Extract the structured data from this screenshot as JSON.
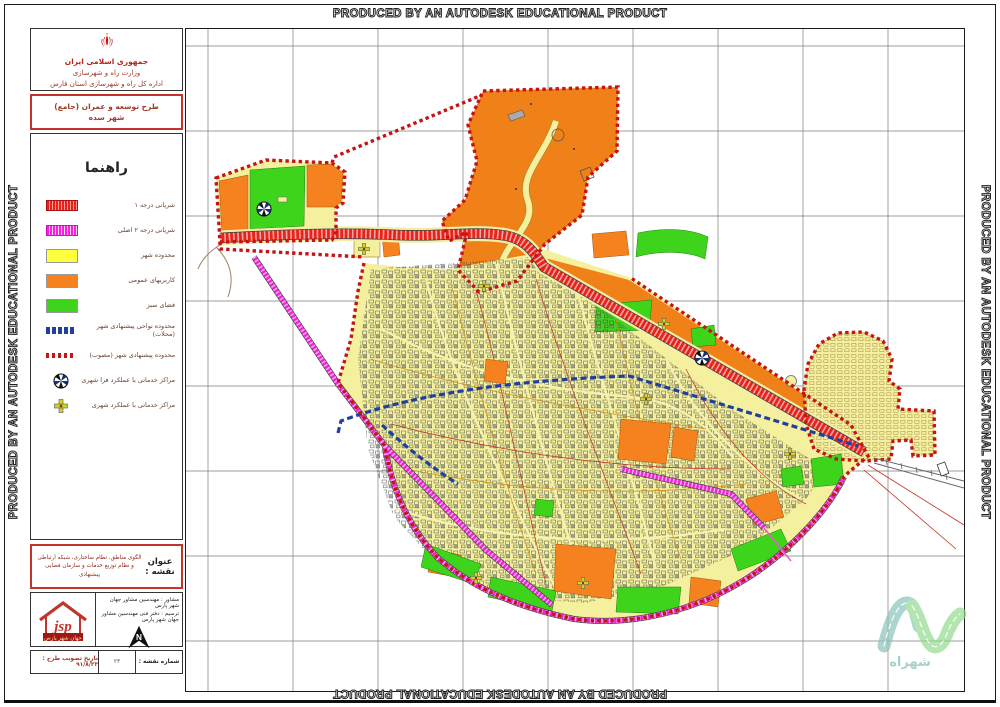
{
  "watermark": {
    "text": "PRODUCED BY AN AUTODESK EDUCATIONAL PRODUCT"
  },
  "header": {
    "line1": "جمهوری اسلامی ایران",
    "line2": "وزارت راه و شهرسازی",
    "line3": "اداره کل راه و شهرسازی استان فارس"
  },
  "plan_box": {
    "line1": "طرح توسعه و عمران (جامع)",
    "line2": "شهر سده"
  },
  "legend": {
    "title": "راهنما",
    "items": [
      {
        "label": "شریانی درجه ۱",
        "swatch": "red-hatch-bar",
        "color": "#e8231a"
      },
      {
        "label": "شریانی درجه ۲ اصلی",
        "swatch": "magenta-hatch-bar",
        "color": "#f024d8"
      },
      {
        "label": "محدوده شهر",
        "swatch": "solid-yellow",
        "color": "#ffff3c"
      },
      {
        "label": "کاربریهای عمومی",
        "swatch": "solid-orange",
        "color": "#f5821e"
      },
      {
        "label": "فضای سبز",
        "swatch": "solid-green",
        "color": "#3fd41c"
      },
      {
        "label": "محدوده نواحی پیشنهادی شهر (محلات)",
        "swatch": "blue-dash-bar",
        "color": "#203f9e"
      },
      {
        "label": "محدوده پیشنهادی شهر (مصوب)",
        "swatch": "red-dot-bar",
        "color": "#c41414"
      },
      {
        "label": "مراکز خدماتی با عملکرد فرا شهری",
        "swatch": "pinwheel-symbol"
      },
      {
        "label": "مراکز خدماتی با عملکرد شهری",
        "swatch": "cross-symbol"
      }
    ]
  },
  "map_title_box": {
    "heading": "عنوان نقشه :",
    "text": "الگوی مناطق، نظام ساختاری، شبکه ارتباطی و نظام توزیع خدمات و سازمان فضایی پیشنهادی"
  },
  "consultant_box": {
    "consultant": "مشاور : مهندسین مشاور جهان شهر پارس",
    "draft": "ترسیم : دفتر فنی مهندسین مشاور جهان شهر پارس",
    "north_label": "N",
    "logo_text": "jsp",
    "logo_caption": "جهان شهر پارس"
  },
  "footer_row": {
    "sheet_label": "شماره نقشه :",
    "sheet_number": "۲۳",
    "date_text": "تاریخ تصویب طرح : ۹۱/۸/۲۳"
  },
  "corner_logo": {
    "text": "شهراه"
  },
  "map": {
    "colors": {
      "city_fill": "#f4f09e",
      "public_orange": "#f5821e",
      "green_space": "#3fd41c",
      "arterial_grade1": "#e8231a",
      "arterial_grade2": "#f024d8",
      "approved_boundary": "#c41414",
      "district_boundary": "#203f9e",
      "grid": "#7d7d7d"
    }
  }
}
